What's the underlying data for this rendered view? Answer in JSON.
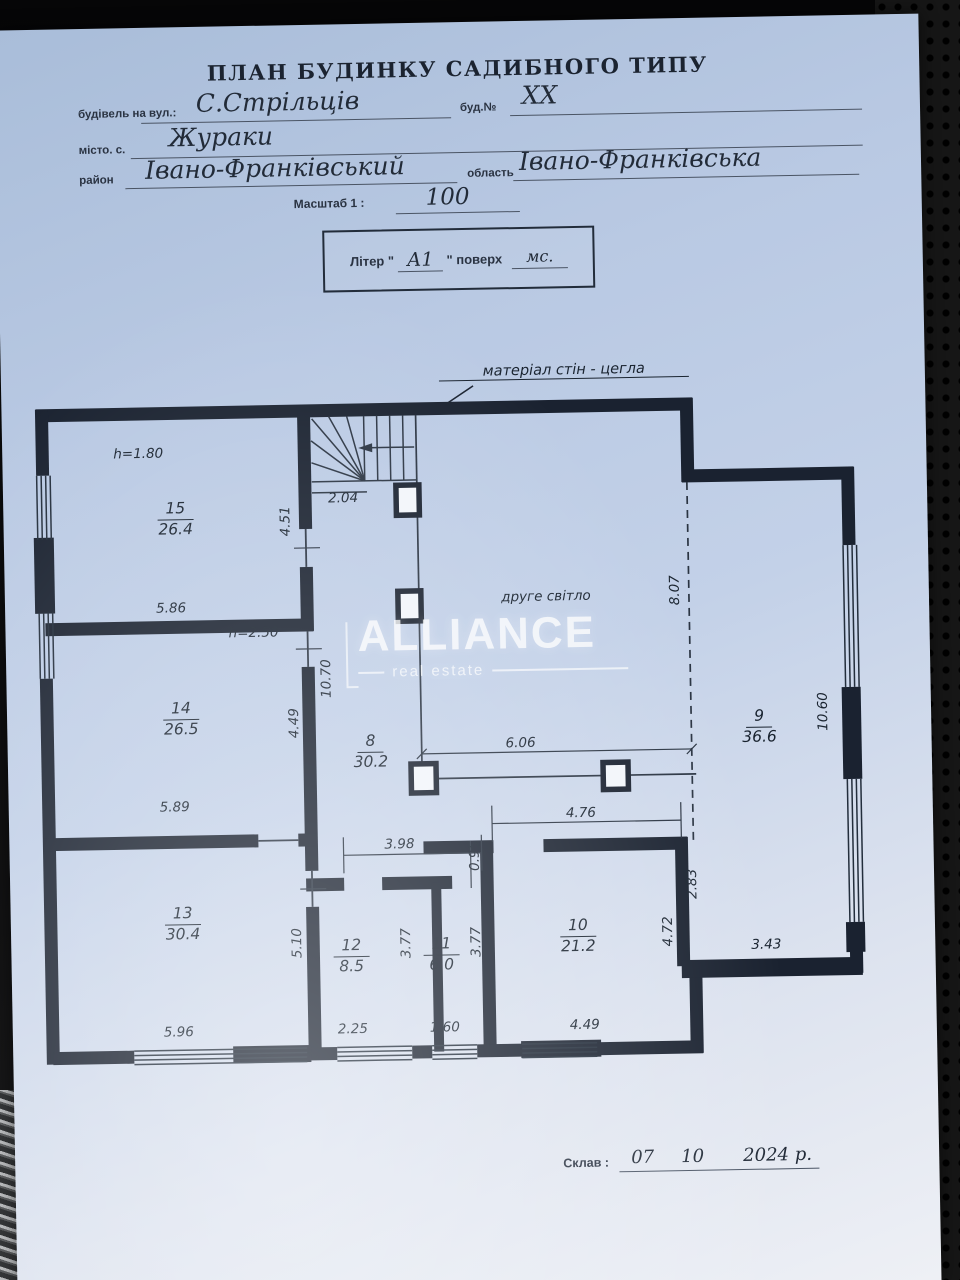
{
  "header": {
    "title": "ПЛАН БУДИНКУ САДИБНОГО ТИПУ",
    "street_label": "будівель на вул.:",
    "street_value": "С.Стрільців",
    "building_no_label": "буд.№",
    "building_no_value": "XX",
    "city_label": "місто. с.",
    "city_value": "Жураки",
    "district_label": "район",
    "district_value": "Івано-Франківський",
    "region_label": "область",
    "region_value": "Івано-Франківська",
    "scale_label": "Масштаб 1 :",
    "scale_value": "100",
    "liter_label": "Літер \"",
    "liter_value": "А1",
    "liter_close": "\"  поверх",
    "liter_floor": "мс."
  },
  "plan": {
    "wall_note": "матеріал стін - цегла",
    "ink_color": "#1a2230",
    "rooms": [
      {
        "n": "15",
        "a": "26.4",
        "x": 148,
        "y": 138
      },
      {
        "n": "14",
        "a": "26.5",
        "x": 150,
        "y": 338
      },
      {
        "n": "13",
        "a": "30.4",
        "x": 148,
        "y": 543
      },
      {
        "n": "12",
        "a": "8.5",
        "x": 316,
        "y": 578
      },
      {
        "n": "11",
        "a": "6.0",
        "x": 406,
        "y": 578
      },
      {
        "n": "10",
        "a": "21.2",
        "x": 543,
        "y": 562
      },
      {
        "n": "8",
        "a": "30.2",
        "x": 339,
        "y": 374
      },
      {
        "n": "9",
        "a": "36.6",
        "x": 728,
        "y": 356
      }
    ],
    "labels": [
      {
        "t": "h=1.80",
        "x": 112,
        "y": 92
      },
      {
        "t": "4.51",
        "x": 258,
        "y": 162,
        "r": 1
      },
      {
        "t": "2.04",
        "x": 316,
        "y": 140
      },
      {
        "t": "5.86",
        "x": 142,
        "y": 247
      },
      {
        "t": "h=2.50",
        "x": 224,
        "y": 273
      },
      {
        "t": "10.70",
        "x": 296,
        "y": 320,
        "r": 1
      },
      {
        "t": "4.49",
        "x": 263,
        "y": 364,
        "r": 1
      },
      {
        "t": "5.89",
        "x": 142,
        "y": 446
      },
      {
        "t": "5.96",
        "x": 142,
        "y": 671
      },
      {
        "t": "5.10",
        "x": 262,
        "y": 584,
        "r": 1
      },
      {
        "t": "3.77",
        "x": 371,
        "y": 586,
        "r": 1
      },
      {
        "t": "2.25",
        "x": 316,
        "y": 671
      },
      {
        "t": "3.77",
        "x": 441,
        "y": 586,
        "r": 1
      },
      {
        "t": "1.60",
        "x": 408,
        "y": 671
      },
      {
        "t": "3.98",
        "x": 366,
        "y": 487
      },
      {
        "t": "0.95",
        "x": 441,
        "y": 500,
        "r": 1
      },
      {
        "t": "4.76",
        "x": 548,
        "y": 459
      },
      {
        "t": "2.83",
        "x": 658,
        "y": 532,
        "r": 1
      },
      {
        "t": "4.72",
        "x": 633,
        "y": 579,
        "r": 1
      },
      {
        "t": "3.43",
        "x": 731,
        "y": 594
      },
      {
        "t": "4.49",
        "x": 548,
        "y": 671
      },
      {
        "t": "6.06",
        "x": 489,
        "y": 388
      },
      {
        "t": "8.07",
        "x": 646,
        "y": 238,
        "r": 1
      },
      {
        "t": "10.60",
        "x": 792,
        "y": 362,
        "r": 1
      },
      {
        "t": "друге світло",
        "x": 517,
        "y": 242
      }
    ]
  },
  "watermark": {
    "brand": "ALLIANCE",
    "sub": "real estate"
  },
  "footer": {
    "label": "Склав :",
    "day": "07",
    "month": "10",
    "year": "2024 р."
  }
}
